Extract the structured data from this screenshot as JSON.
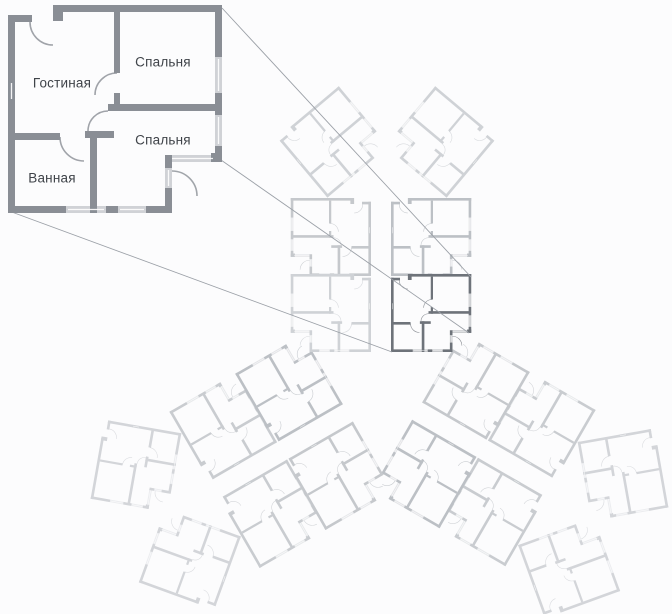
{
  "diagram": {
    "title": "apartment-building-floor-plan",
    "callout": {
      "rooms": [
        {
          "label": "Гостиная"
        },
        {
          "label": "Спальня"
        },
        {
          "label": "Спальня"
        },
        {
          "label": "Ванная"
        }
      ]
    },
    "building": {
      "wings": 3,
      "units_per_wing": 6,
      "highlighted_unit": "top-wing-right-column-bottom"
    }
  },
  "colors": {
    "background": "#fcfcfd",
    "enlarged_wall": "#8a8e95",
    "highlight_wall": "#6e737a",
    "faded_wall": "#c5c8cc",
    "window_line": "#ffffff",
    "callout_line": "#9ba0a7",
    "label_text": "#3f4349"
  }
}
